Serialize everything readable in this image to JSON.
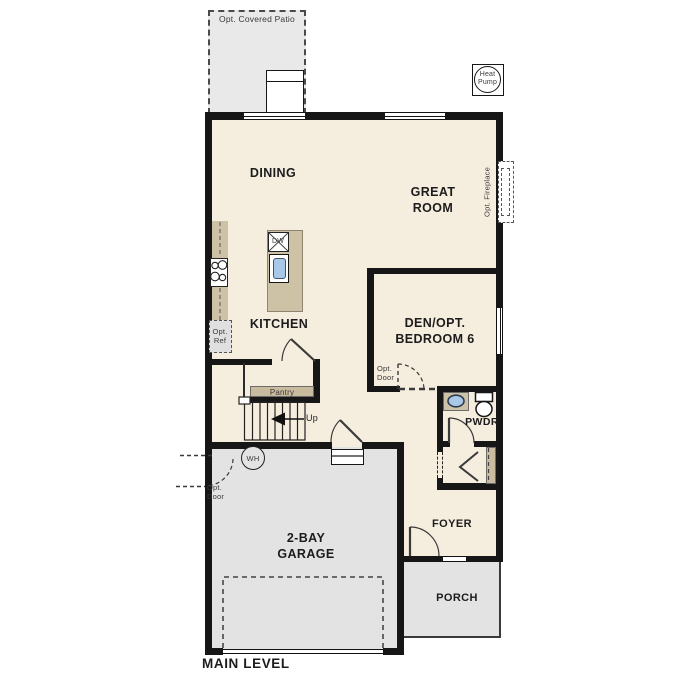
{
  "plan": {
    "level_label": "MAIN LEVEL"
  },
  "rooms": {
    "dining": "DINING",
    "great_room": "GREAT\nROOM",
    "kitchen": "KITCHEN",
    "den": "DEN/OPT.\nBEDROOM 6",
    "powder": "PWDR",
    "foyer": "FOYER",
    "garage": "2-BAY\nGARAGE",
    "porch": "PORCH"
  },
  "features": {
    "covered_patio": "Opt. Covered Patio",
    "heat_pump": "Heat\nPump",
    "fireplace": "Opt. Fireplace",
    "opt_ref": "Opt.\nRef",
    "pantry": "Pantry",
    "stairs_up": "Up",
    "water_heater": "WH",
    "opt_door": "Opt.\nDoor",
    "dishwasher": "DW"
  },
  "colors": {
    "wall": "#161616",
    "floor": "#f5edde",
    "concrete": "#e3e3e3",
    "patio": "#e9e9e9",
    "counter": "#cec2a6",
    "shelf": "#c9bc9e",
    "sink_blue": "#a9c7e7"
  }
}
